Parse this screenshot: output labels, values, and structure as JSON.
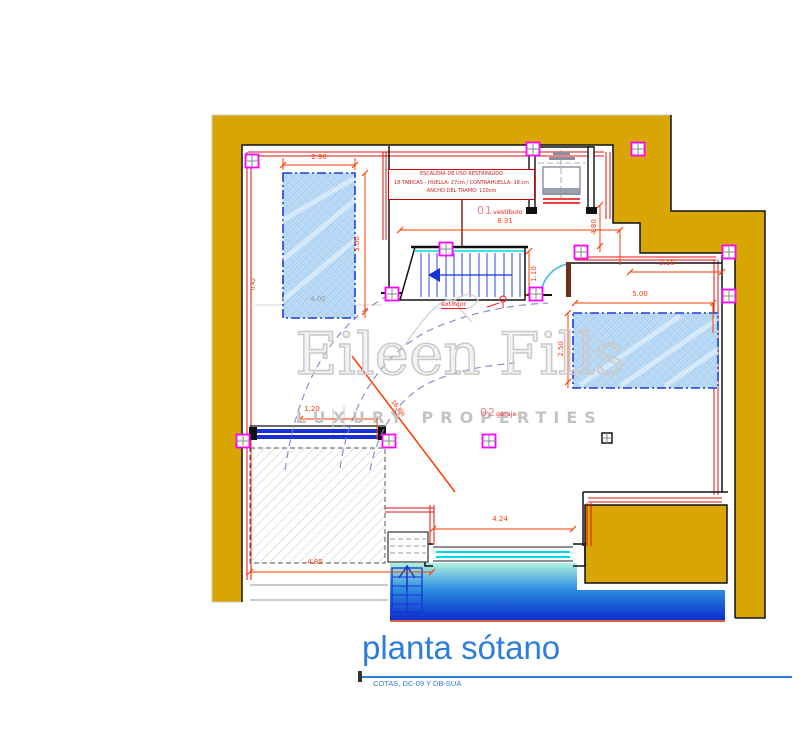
{
  "drawing": {
    "title": "planta sótano",
    "subtitle": "COTAS, DC-09 Y DB-SUA"
  },
  "stair_note": {
    "line1": "ESCALERA DE USO RESTRINGIDO",
    "line2": "18 TABICAS - HUELLA: 27cm / CONTRAHUELLA: 18.cm",
    "line3": "ANCHO DEL TRAMO: 110cm"
  },
  "rooms": [
    {
      "number": "01",
      "name": "vestíbulo"
    },
    {
      "number": "02",
      "name": "garaje"
    }
  ],
  "annotations": {
    "extintor": "extintor",
    "ramp_slope": "16.8%"
  },
  "watermark": {
    "name": "Eileen Fills",
    "tagline": "LUXURY PROPERTIES"
  },
  "dimensions": [
    {
      "text": "2.90"
    },
    {
      "text": "5.00"
    },
    {
      "text": "4.00"
    },
    {
      "text": "8.31"
    },
    {
      "text": "4.80"
    },
    {
      "text": "3.10"
    },
    {
      "text": "5.00"
    },
    {
      "text": "2.50"
    },
    {
      "text": "1.10"
    },
    {
      "text": "1.20"
    },
    {
      "text": "4.24"
    },
    {
      "text": "4.85"
    },
    {
      "text": "0.42"
    }
  ],
  "colors": {
    "wall_fill": "#D9A502",
    "dimension_red": "#FF3B00",
    "hatch_blue": "#BFDDF7",
    "hatch_blue_border": "#1B3FD6",
    "glass_cyan": "#00D8E8",
    "column_marker_magenta": "#FF00FF",
    "water_top": "#AFF2DE",
    "water_bottom": "#0A2ECC",
    "title_blue": "#2E7CE0"
  }
}
